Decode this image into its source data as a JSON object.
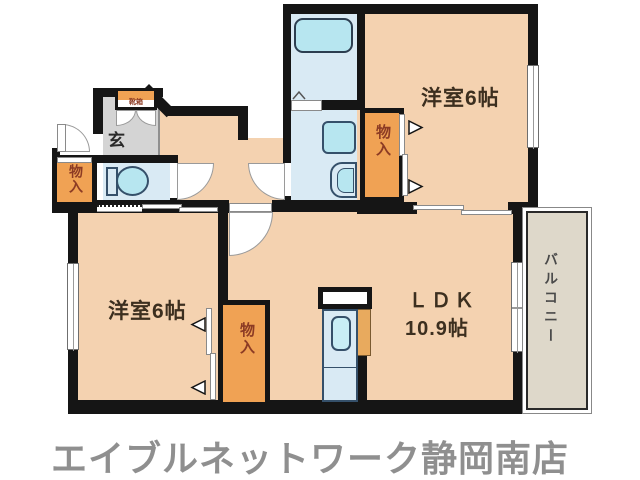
{
  "floorplan": {
    "rooms": {
      "western_top": {
        "label": "洋室6帖"
      },
      "western_bottom": {
        "label": "洋室6帖"
      },
      "ldk": {
        "line1": "ＬＤＫ",
        "line2": "10.9帖"
      },
      "balcony": {
        "label": "バルコニー"
      },
      "entrance": {
        "label": "玄"
      }
    },
    "closets": {
      "top": {
        "label": "物入"
      },
      "left": {
        "label": "物入"
      },
      "bottom": {
        "label": "物入"
      }
    },
    "entrance_cabinet": {
      "label": "靴箱"
    },
    "footer": {
      "store_name": "エイブルネットワーク静岡南店"
    },
    "colors": {
      "room_floor": "#f4d2b0",
      "closet_fill": "#f0a254",
      "wet_area": "#d9eaf4",
      "fixture": "#b7e6f0",
      "genkan_floor": "#d4d4d4",
      "balcony_fill": "#ded8ca",
      "wall": "#151515",
      "closet_text": "#8c3b24",
      "label_text": "#3c2f1f",
      "footer_text": "#8f8f8f"
    }
  }
}
